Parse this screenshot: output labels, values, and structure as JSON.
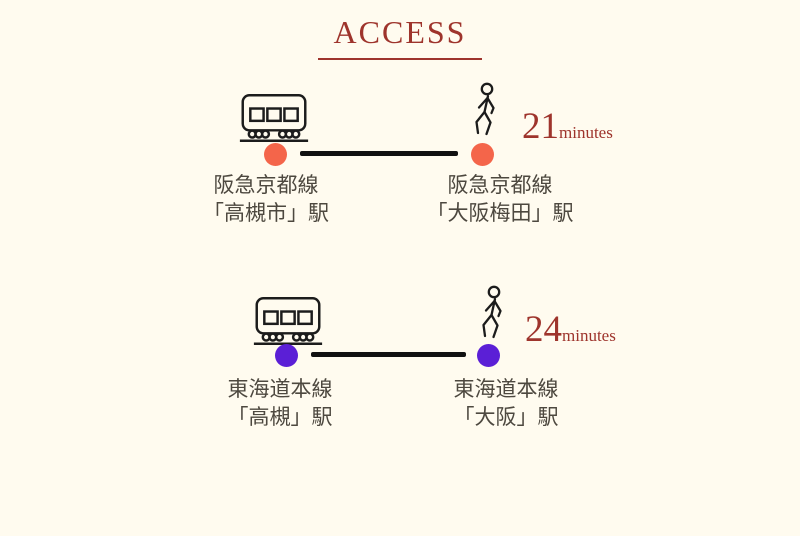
{
  "page": {
    "title": "ACCESS",
    "background_color": "#FFFBEF",
    "accent_color": "#9E342C",
    "line_color": "#111111",
    "station_text_color": "#4D483F"
  },
  "icons": {
    "train": "train-icon",
    "walk": "walking-person-icon",
    "station_marker": "station-dot"
  },
  "routes": [
    {
      "name": "hankyu-kyoto-line-route",
      "dot_color": "#F4654A",
      "from": {
        "line": "阪急京都線",
        "station": "「高槻市」駅"
      },
      "to": {
        "line": "阪急京都線",
        "station": "「大阪梅田」駅"
      },
      "duration_value": "21",
      "duration_unit": "minutes"
    },
    {
      "name": "tokaido-main-line-route",
      "dot_color": "#5B1FD6",
      "from": {
        "line": "東海道本線",
        "station": "「高槻」駅"
      },
      "to": {
        "line": "東海道本線",
        "station": "「大阪」駅"
      },
      "duration_value": "24",
      "duration_unit": "minutes"
    }
  ]
}
